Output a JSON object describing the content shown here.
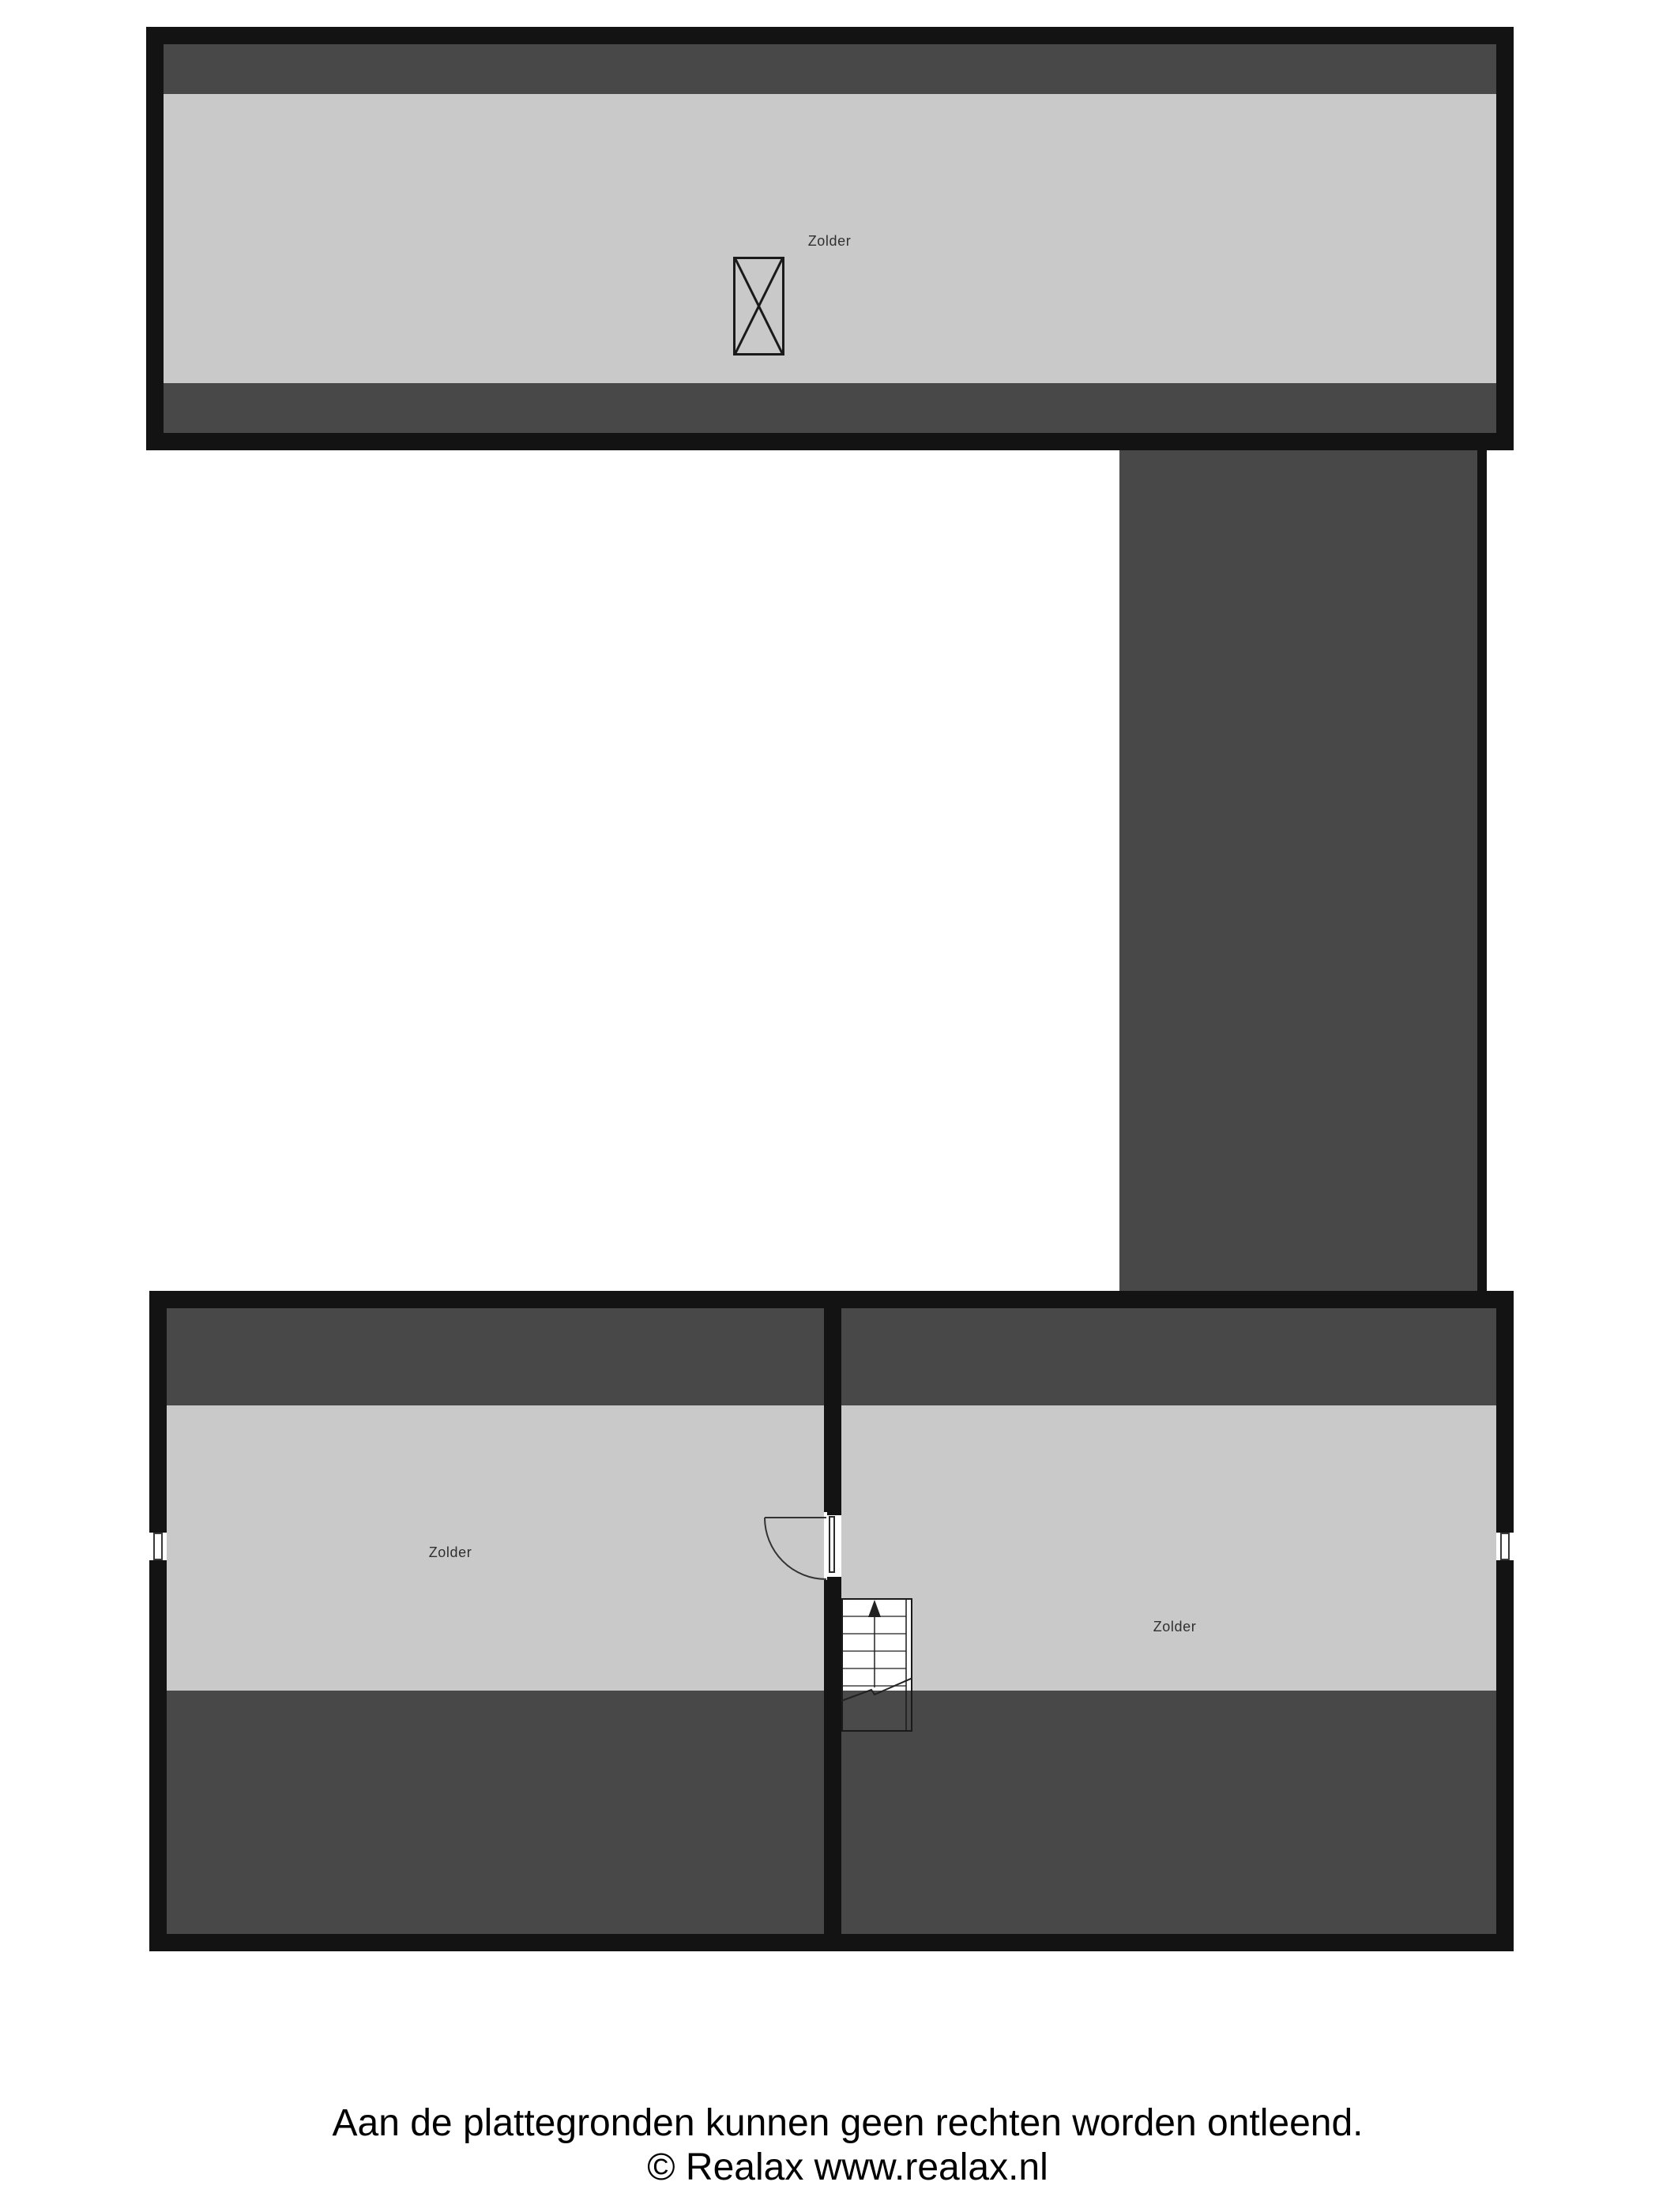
{
  "plan": {
    "rooms": {
      "top": {
        "label": "Zolder"
      },
      "bottom_left": {
        "label": "Zolder"
      },
      "bottom_right": {
        "label": "Zolder"
      }
    },
    "symbols": {
      "chimney": "crossed-box shaft symbol",
      "stairs": "staircase with up arrow and break line",
      "door": "quarter-circle door swing",
      "window": "double-line window in wall"
    }
  },
  "footer": {
    "line1": "Aan de plattegronden kunnen geen rechten worden ontleend.",
    "line2": "© Realax www.realax.nl"
  },
  "colors": {
    "wall": "#131313",
    "roof_slope": "#484848",
    "floor": "#c9c9c9",
    "background": "#ffffff",
    "label_text": "#2f2f2f",
    "footer_text": "#000000",
    "symbol_line": "#2a2a2a"
  }
}
